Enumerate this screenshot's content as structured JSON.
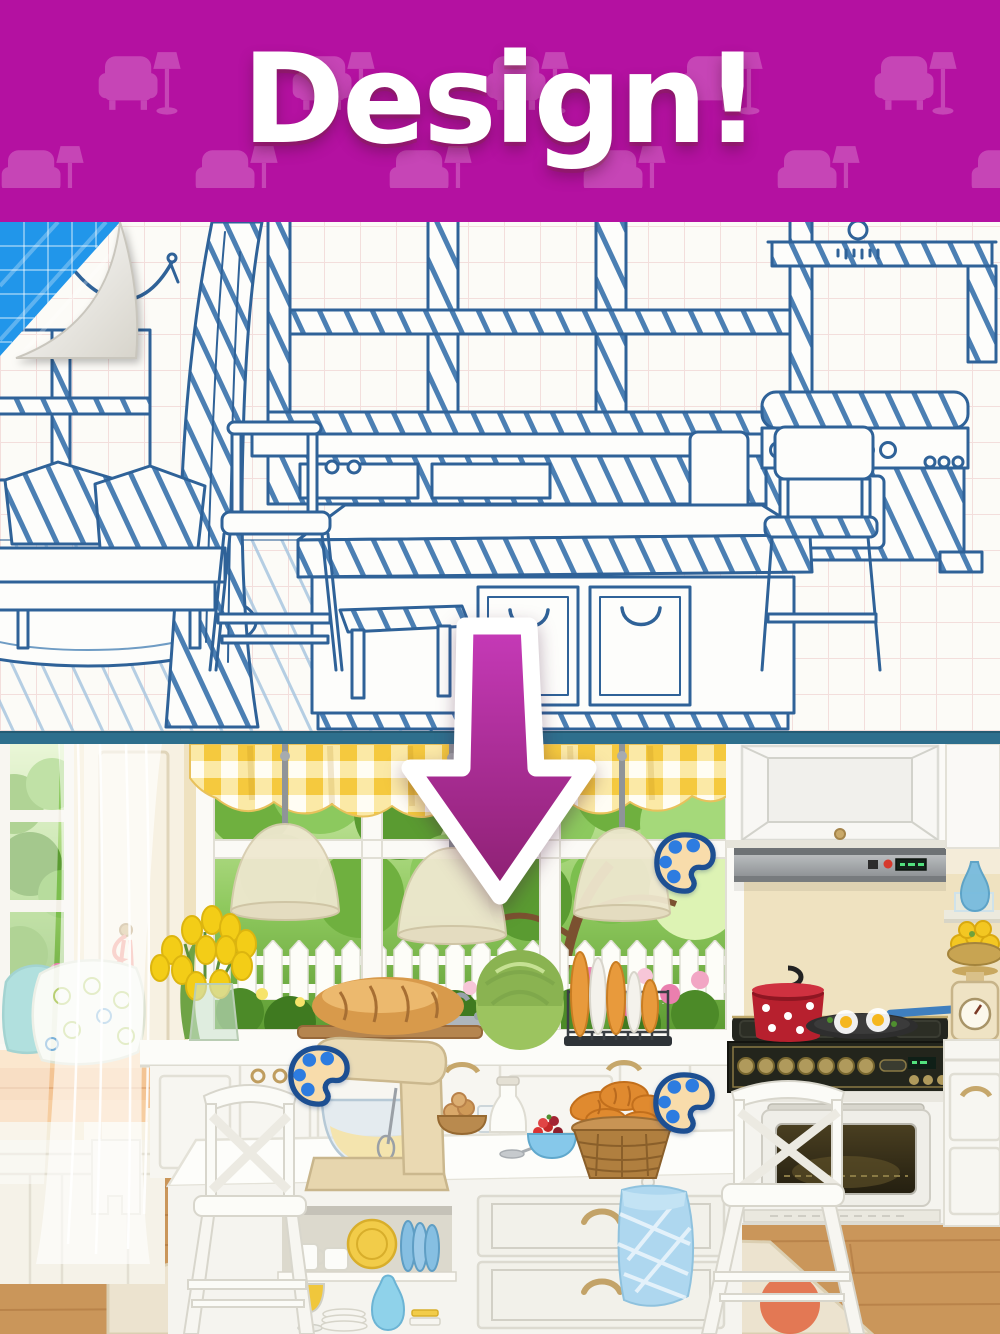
{
  "header": {
    "title": "Design!"
  },
  "icons": {
    "header_pattern_icon": "armchair-floor-lamp-icon",
    "arrow_icon": "down-arrow-icon",
    "palette_icon": "paint-palette-icon",
    "palette_icon_count": 3
  },
  "scene": {
    "top_panel": "hand-drawn kitchen blueprint sketch on graph paper",
    "bottom_panel": "finished colorful kitchen illustration"
  },
  "theme": {
    "header-bg": "#b411a1",
    "header-pattern": "#cb52bb",
    "header-edge": "#8d0c7d",
    "title-color": "#ffffff",
    "divider-color": "#2e6f8d",
    "paper-color": "#fcfbf7",
    "grid-color": "#f3dedc",
    "ink-color": "#2f6298",
    "fold-blue": "#2196ea",
    "arrow-top": "#c63ab8",
    "arrow-bottom": "#8c2071",
    "valance-yellow": "#f5c93e",
    "wall-beige": "#efe2c0",
    "floor-wood": "#ca965a",
    "palette-fill": "#f8dcab",
    "palette-outline": "#1d4f92",
    "palette-dot": "#2d7ce0"
  }
}
